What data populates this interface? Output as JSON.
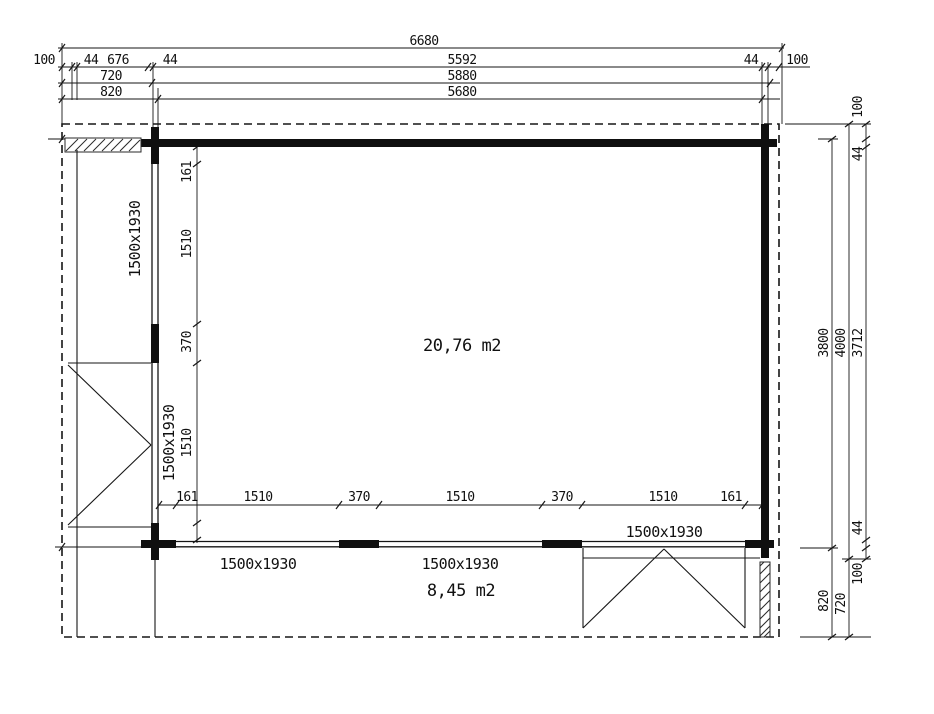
{
  "drawing": {
    "type": "floor-plan",
    "units": "mm",
    "line_color": "#161616",
    "background": "#ffffff"
  },
  "dims": {
    "top": {
      "total": "6680",
      "row2": [
        "100",
        "44",
        "676",
        "44",
        "5592",
        "44",
        "100"
      ],
      "row3": [
        "720",
        "5880"
      ],
      "row4": [
        "820",
        "5680"
      ]
    },
    "right": {
      "outer": [
        "3800",
        "820"
      ],
      "middle": [
        "4000",
        "720"
      ],
      "inner": [
        "100",
        "44",
        "3712",
        "44",
        "100"
      ]
    },
    "left_col": [
      "161",
      "1510",
      "370",
      "1510"
    ],
    "bottom_row": [
      "161",
      "1510",
      "370",
      "1510",
      "370",
      "1510",
      "161"
    ]
  },
  "openings": {
    "left_window": "1500x1930",
    "left_door": "1500x1930",
    "bottom_window_1": "1500x1930",
    "bottom_window_2": "1500x1930",
    "bottom_door": "1500x1930"
  },
  "areas": {
    "main_room": "20,76 m2",
    "porch": "8,45 m2"
  }
}
